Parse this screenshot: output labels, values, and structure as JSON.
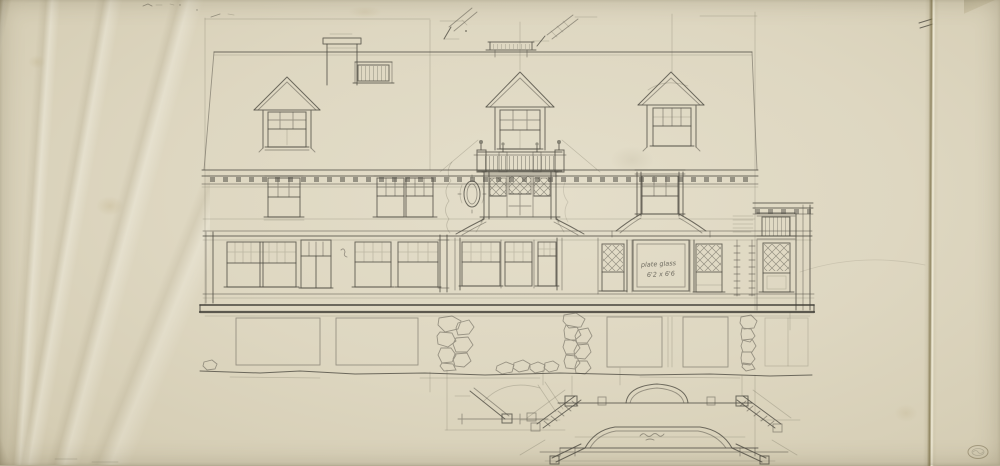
{
  "colors": {
    "paper": "#ded7c1",
    "paper_shadow": "#ccc3a8",
    "pencil": "#4b4940",
    "construction_line": "#6e6a5a",
    "fold_crease": "#72663c",
    "stamp": "#998e72"
  },
  "annotations": {
    "plate_glass_note_line1": "plate glass",
    "plate_glass_note_line2": "6'2 x 6'6",
    "plan_scribble": "illegible pencil scribble",
    "corner_stamp": "illegible embossed oval stamp"
  }
}
